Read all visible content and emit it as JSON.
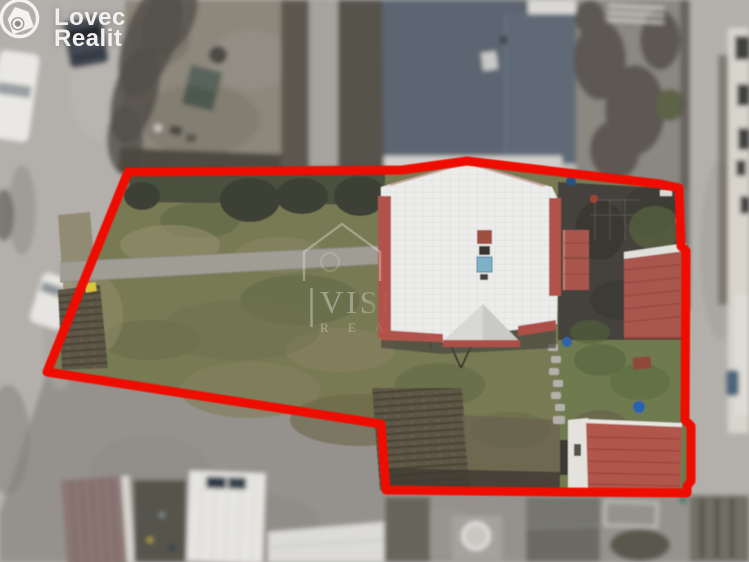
{
  "branding": {
    "name_line1": "Lovec",
    "name_line2": "Realit"
  },
  "watermark": {
    "line1": "VISI",
    "line2": "R E A"
  },
  "colors": {
    "boundary": "#ee1000",
    "road": "#b3b0ac",
    "gravel": "#95928d",
    "lawn": "#777a53",
    "lawn_right": "#6f7a50",
    "blue_roof": "#5b6571",
    "white_roof": "#ecedeb",
    "terracotta": "#b1524b",
    "garage_roof": "#a9564e",
    "shed_roof": "#b0564c",
    "courtyard": "#45423c"
  }
}
